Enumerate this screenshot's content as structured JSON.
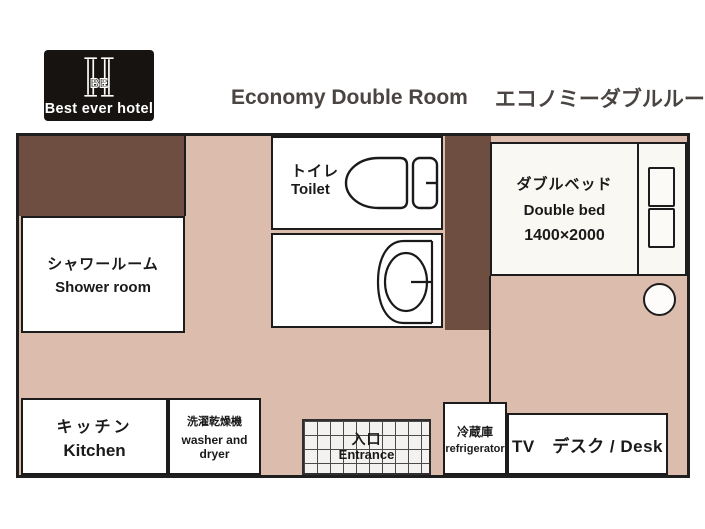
{
  "header": {
    "brand": "Best ever hotel",
    "monogram": "BE",
    "title_en": "Economy Double Room",
    "title_ja": "エコノミーダブルルーム",
    "area_label": "17 m",
    "area_sup": "2"
  },
  "rooms": {
    "shower": {
      "ja": "シャワールーム",
      "en": "Shower room"
    },
    "toilet": {
      "ja": "トイレ",
      "en": "Toilet"
    },
    "bed": {
      "ja": "ダブルベッド",
      "en": "Double bed",
      "size": "1400×2000"
    },
    "kitchen": {
      "ja": "キッチン",
      "en": "Kitchen"
    },
    "washer": {
      "ja": "洗濯乾燥機",
      "en": "washer and dryer"
    },
    "entrance": {
      "ja": "入口",
      "en": "Entrance"
    },
    "refrigerator": {
      "ja": "冷蔵庫",
      "en": "refrigerator"
    },
    "tv_desk": {
      "label": "TV　デスク / Desk"
    }
  },
  "icons": {
    "monogram": "hotel-monogram-icon",
    "toilet": "toilet-plan-icon",
    "sink": "sink-plan-icon",
    "pillows": "pillow-icons",
    "stool": "stool-icon"
  },
  "colors": {
    "floor": "#dcbcad",
    "wall_dark": "#6d4e40",
    "outline": "#1c1c1c",
    "logo_bg": "#171310",
    "title_text": "#4a4442",
    "room_fill": "#ffffff"
  }
}
